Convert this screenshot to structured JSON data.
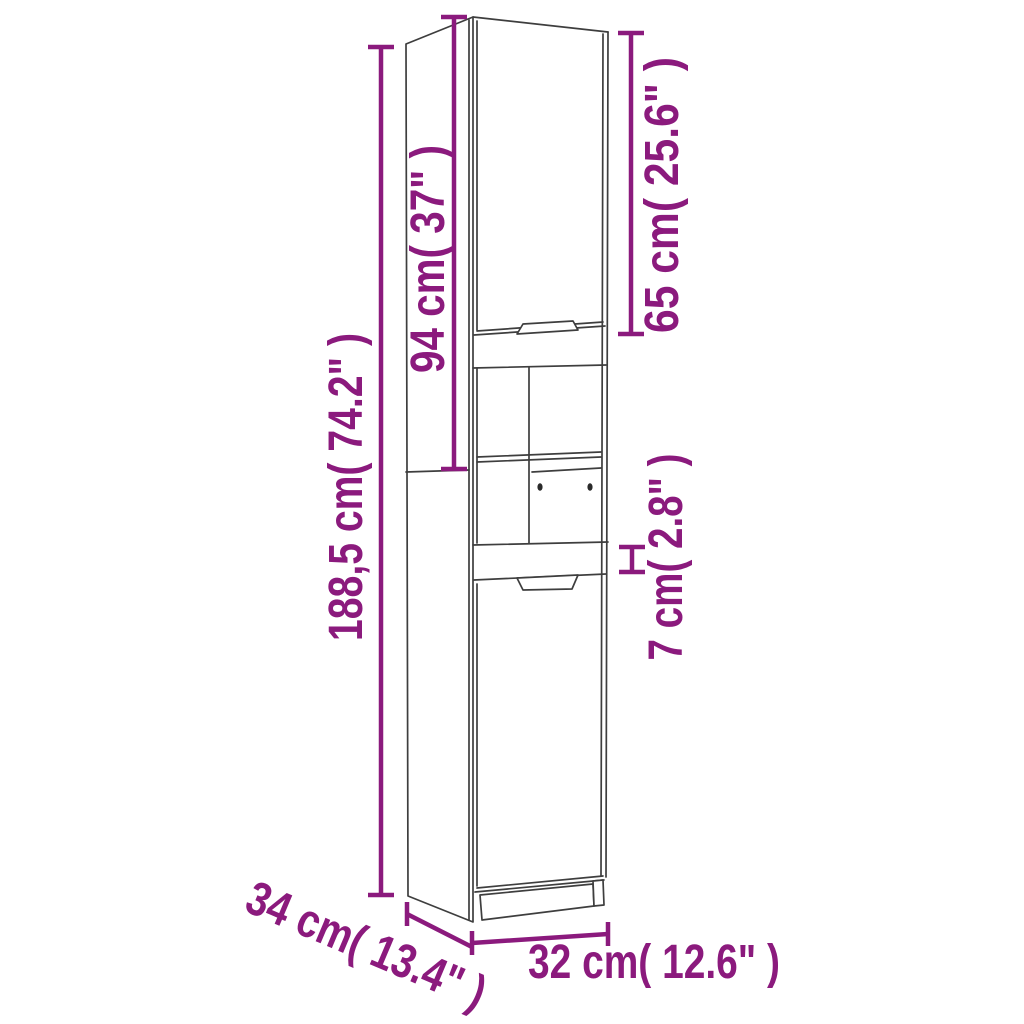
{
  "diagram": {
    "type": "product-dimension-drawing",
    "subject": "tall bathroom storage cabinet",
    "background_color": "#ffffff",
    "accent_color": "#8B1A7D",
    "line_color": "#3E3E3E",
    "dimensions": {
      "total_height": "188,5 cm( 74.2\" )",
      "upper_unit_height": "94 cm( 37\" )",
      "upper_door_height": "65 cm( 25.6\" )",
      "middle_band_height": "7 cm( 2.8\" )",
      "depth": "34 cm( 13.4\" )",
      "width": "32 cm( 12.6\" )"
    }
  }
}
